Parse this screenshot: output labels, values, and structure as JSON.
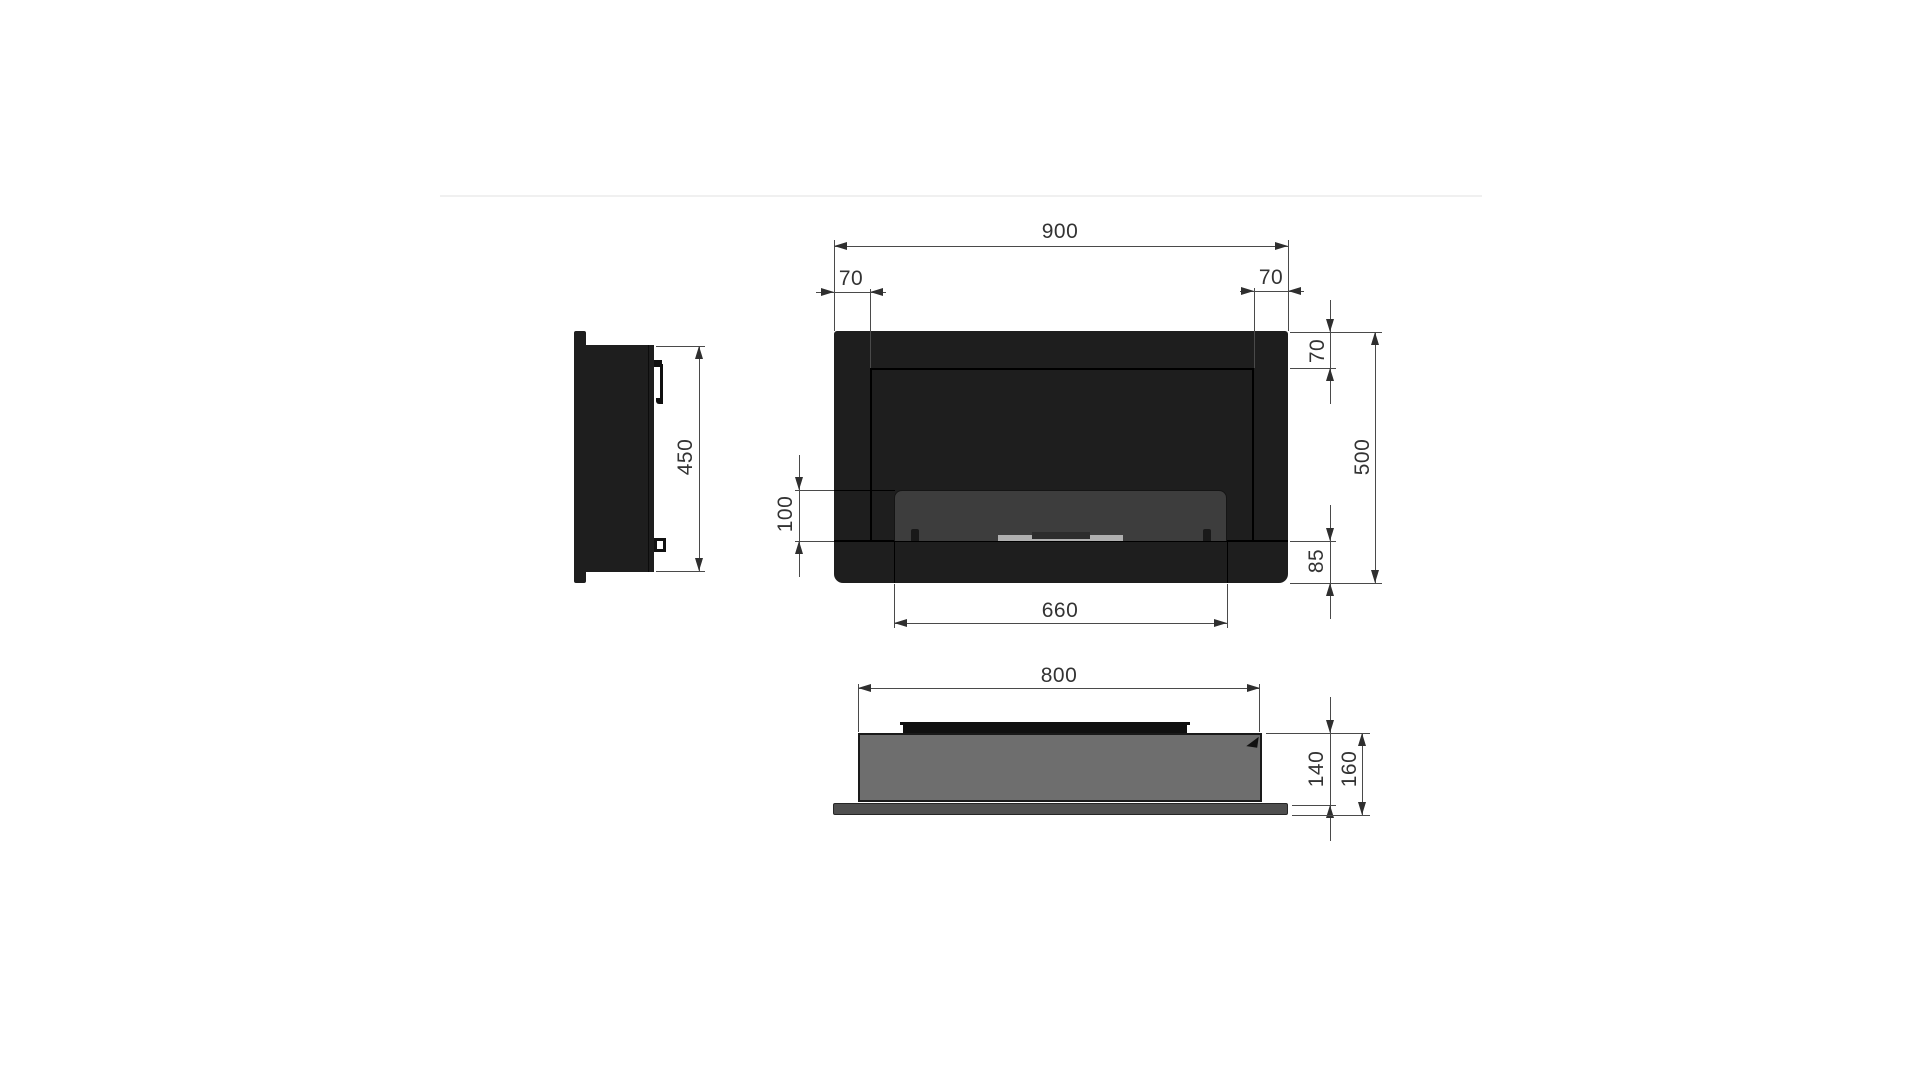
{
  "drawing": {
    "front_view": {
      "width": "900",
      "margin_left": "70",
      "margin_right": "70",
      "margin_top": "70",
      "height": "500",
      "opening_height": "100",
      "base_height": "85",
      "opening_width": "660"
    },
    "side_view": {
      "body_height": "450"
    },
    "bottom_view": {
      "body_width": "800",
      "body_depth": "140",
      "total_depth": "160"
    }
  },
  "colors": {
    "background": "#ffffff",
    "body_black": "#1e1e1e",
    "seam_black": "#000000",
    "glass_gray": "#3d3d3d",
    "burner_silver": "#b0b0b0",
    "burner_center_dark": "#2d2d2d",
    "box_gray": "#6e6e6e",
    "plate_gray": "#4f4f4f",
    "dim_line": "#4a4a4a",
    "dim_arrow": "#2f2f2f",
    "dim_text": "#333333",
    "divider": "#f0f0f0"
  }
}
